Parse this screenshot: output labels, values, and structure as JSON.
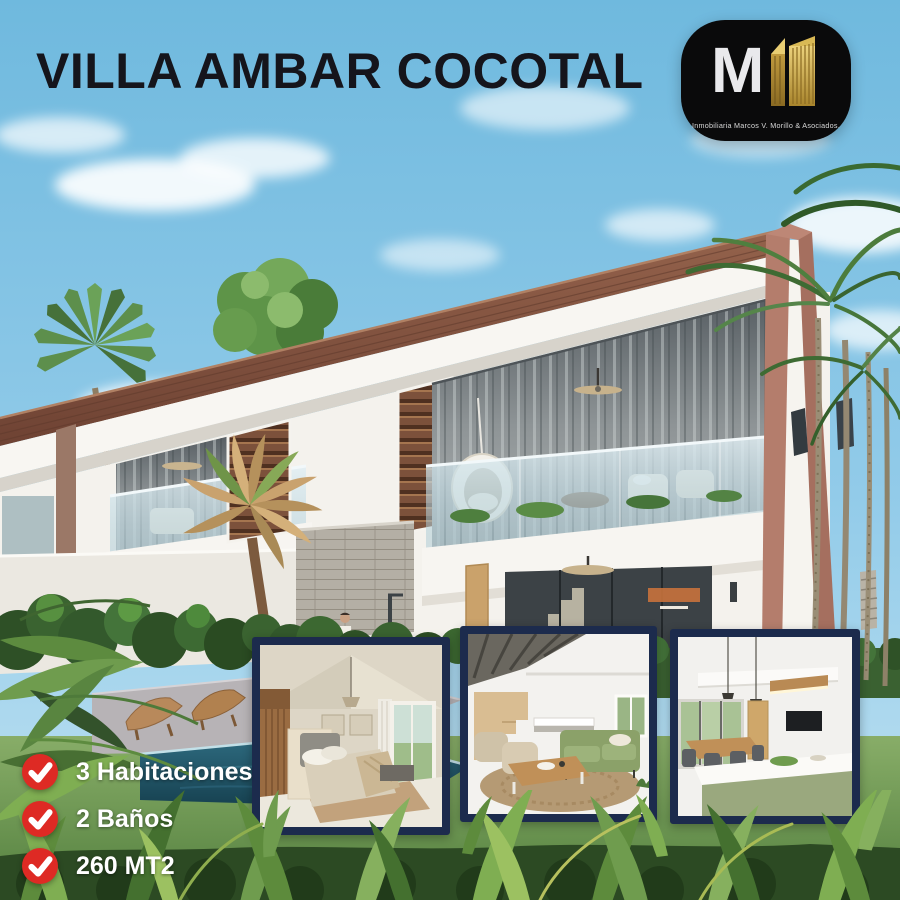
{
  "poster": {
    "title": "VILLA AMBAR COCOTAL",
    "logo": {
      "monogram": "M",
      "caption": "Inmobiliaria Marcos V. Morillo & Asociados."
    },
    "features": [
      {
        "icon": "check-icon",
        "label": "3 Habitaciones"
      },
      {
        "icon": "check-icon",
        "label": "2 Baños"
      },
      {
        "icon": "check-icon",
        "label": "260 MT2"
      }
    ],
    "gallery": [
      {
        "name": "bedroom-photo"
      },
      {
        "name": "living-room-photo"
      },
      {
        "name": "kitchen-photo"
      }
    ],
    "colors": {
      "title_text": "#15151c",
      "feature_text": "#ffffff",
      "check_red": "#de2a24",
      "photo_border": "#1c2b4d",
      "logo_background": "#0a0a0b",
      "logo_monogram": "#e9e9ec",
      "logo_gold": "#d8b458",
      "sky_blue": "#8ac6e6",
      "roof_brown": "#7e4e3b",
      "gable_terracotta": "#b47d6c",
      "pool_teal": "#23596e"
    }
  }
}
